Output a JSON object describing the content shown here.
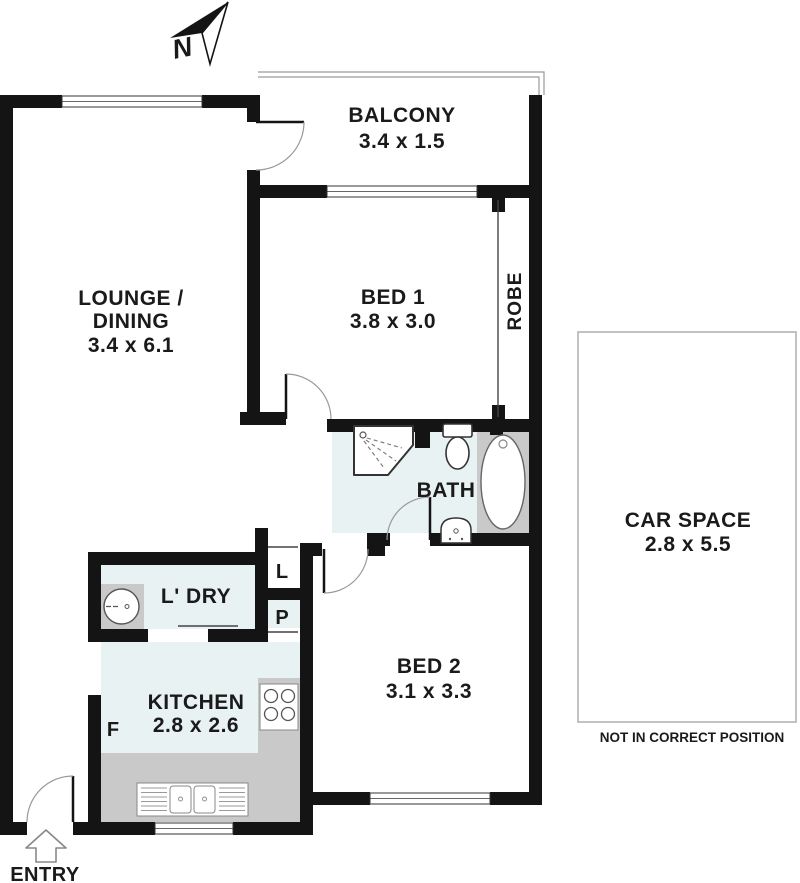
{
  "compass": {
    "label": "N"
  },
  "rooms": {
    "balcony": {
      "name": "BALCONY",
      "dims": "3.4 x 1.5"
    },
    "lounge": {
      "line1": "LOUNGE /",
      "line2": "DINING",
      "dims": "3.4 x 6.1"
    },
    "bed1": {
      "name": "BED 1",
      "dims": "3.8 x 3.0"
    },
    "robe": {
      "name": "ROBE"
    },
    "bath": {
      "name": "BATH"
    },
    "bed2": {
      "name": "BED 2",
      "dims": "3.1 x 3.3"
    },
    "laundry": {
      "name": "L' DRY"
    },
    "kitchen": {
      "name": "KITCHEN",
      "dims": "2.8 x 2.6"
    },
    "linen_cupboard": {
      "name": "L"
    },
    "pantry": {
      "name": "P"
    },
    "fridge": {
      "name": "F"
    },
    "car_space": {
      "name": "CAR SPACE",
      "dims": "2.8 x 5.5",
      "note": "NOT IN CORRECT POSITION"
    }
  },
  "entry": {
    "label": "ENTRY"
  },
  "colors": {
    "wall": "#141414",
    "room_tint": "#e9f2f2",
    "counter": "#c9c9c9",
    "fixture_stroke": "#444444",
    "arc": "#999999",
    "rail": "#9a9a9a",
    "car_space_border": "#b3b3b3",
    "text": "#1a1a1a"
  }
}
